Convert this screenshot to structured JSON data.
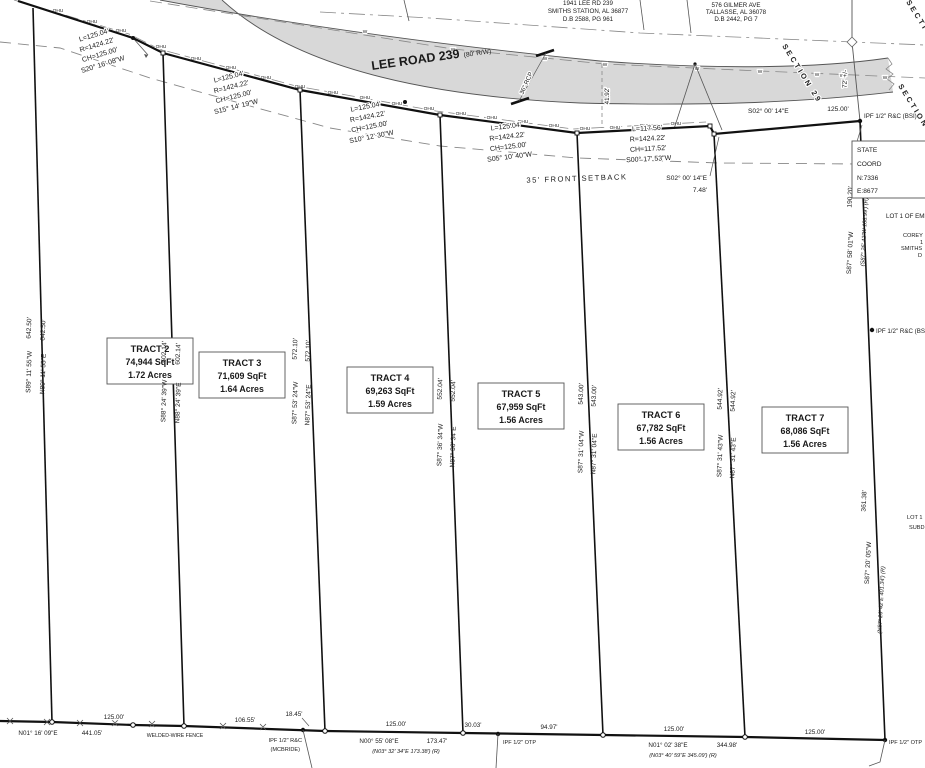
{
  "plat": {
    "road": {
      "name": "LEE ROAD 239",
      "rw": "(80' R/W)"
    },
    "utilities": {
      "ohu": "OHU",
      "water": "W",
      "rcp": "36\" RCP",
      "dim": "41.92'"
    },
    "sections": {
      "s29": "SECTION 29",
      "s32": "SECTION 32",
      "s33": "SECTION 33",
      "gap": "72' +/-"
    },
    "owners": {
      "left": {
        "l1": "1941 LEE RD 239",
        "l2": "SMITHS STATION, AL 36877",
        "l3": "D.B 2588, PG 961"
      },
      "right": {
        "l1": "576 GILMER AVE",
        "l2": "TALLASSE, AL 36078",
        "l3": "D.B 2442, PG 7"
      }
    },
    "curves": [
      {
        "l": "L=125.04'",
        "r": "R=1424.22'",
        "ch": "CH=125.00'",
        "brg": "S20° 16' 08\"W"
      },
      {
        "l": "L=125.04'",
        "r": "R=1424.22'",
        "ch": "CH=125.00'",
        "brg": "S15° 14' 19\"W"
      },
      {
        "l": "L=125.04'",
        "r": "R=1424.22'",
        "ch": "CH=125.00'",
        "brg": "S10° 12' 30\"W"
      },
      {
        "l": "L=125.04'",
        "r": "R=1424.22'",
        "ch": "CH=125.00'",
        "brg": "S05° 10' 40\"W"
      },
      {
        "l": "L=117.56'",
        "r": "R=1424.22'",
        "ch": "CH=117.52'",
        "brg": "S00° 17' 53\"W"
      }
    ],
    "north": {
      "brg": "S02° 00' 14\"E",
      "len": "125.00'",
      "jog_brg": "S02° 00' 14\"E",
      "jog_len": "7.48'",
      "setback": "35' FRONT SETBACK"
    },
    "tracts": [
      {
        "name": "TRACT 2",
        "sqft": "74,944 SqFt",
        "acres": "1.72 Acres"
      },
      {
        "name": "TRACT 3",
        "sqft": "71,609 SqFt",
        "acres": "1.64 Acres"
      },
      {
        "name": "TRACT 4",
        "sqft": "69,263 SqFt",
        "acres": "1.59 Acres"
      },
      {
        "name": "TRACT 5",
        "sqft": "67,959 SqFt",
        "acres": "1.56 Acres"
      },
      {
        "name": "TRACT 6",
        "sqft": "67,782 SqFt",
        "acres": "1.56 Acres"
      },
      {
        "name": "TRACT 7",
        "sqft": "68,086 SqFt",
        "acres": "1.56 Acres"
      }
    ],
    "sides": [
      {
        "d": "642.50'",
        "b1": "S89° 11' 55\"W",
        "b2": "N89° 11' 55\"E"
      },
      {
        "d": "602.14'",
        "b1": "S88° 24' 39\"W",
        "b2": "N88° 24' 39\"E"
      },
      {
        "d": "572.10'",
        "b1": "S87° 53' 24\"W",
        "b2": "N87° 53' 24\"E"
      },
      {
        "d": "552.04'",
        "b1": "S87° 36' 34\"W",
        "b2": "N87° 36' 34\"E"
      },
      {
        "d": "543.00'",
        "b1": "S87° 31' 04\"W",
        "b2": "N87° 31' 04\"E"
      },
      {
        "d": "544.92'",
        "b1": "S87° 31' 43\"W",
        "b2": "N87° 31' 43\"E"
      }
    ],
    "east": {
      "upper": {
        "d": "190.20'",
        "b": "S87° 58' 01\"W",
        "rec": "(S87° 26' 42\"W  188.99') (R)"
      },
      "lower": {
        "d": "361.38'",
        "b": "S87° 20' 05\"W",
        "rec": "(N87° 26' 42\"E  401.34') (R)"
      }
    },
    "south": {
      "w2": "125.00'",
      "w3a": "106.55'",
      "w3b": "18.45'",
      "w4": "125.00'",
      "w5a": "30.03'",
      "w5b": "94.97'",
      "w6": "125.00'",
      "w7": "125.00'",
      "run1_brg": "N01° 16' 09\"E",
      "run1_len": "441.05'",
      "run2_brg": "N00° 55' 08\"E",
      "run2_len": "173.47'",
      "run2_rec": "(N03° 32' 34\"E  173.38') (R)",
      "run3_brg": "N01° 02' 38\"E",
      "run3_len": "344.98'",
      "run3_rec": "(N03° 40' 59\"E  345.09') (R)",
      "fence": "WELDED-WIRE FENCE"
    },
    "monuments": {
      "bsi": "IPF 1/2\" R&C (BSI)",
      "mcbride1": "IPF 1/2\" R&C",
      "mcbride2": "(MCBRIDE)",
      "otp": "IPF 1/2\" OTP"
    },
    "clipped": {
      "coord1": "STATE",
      "coord2": "COORD",
      "coord3": "N:7336",
      "coord4": "E:8677",
      "lot1": "LOT 1 OF EME",
      "own1": "COREY",
      "own2": "1",
      "own3": "SMITHS",
      "own4": "D",
      "lot2a": "LOT 1",
      "lot2b": "SUBD"
    }
  }
}
